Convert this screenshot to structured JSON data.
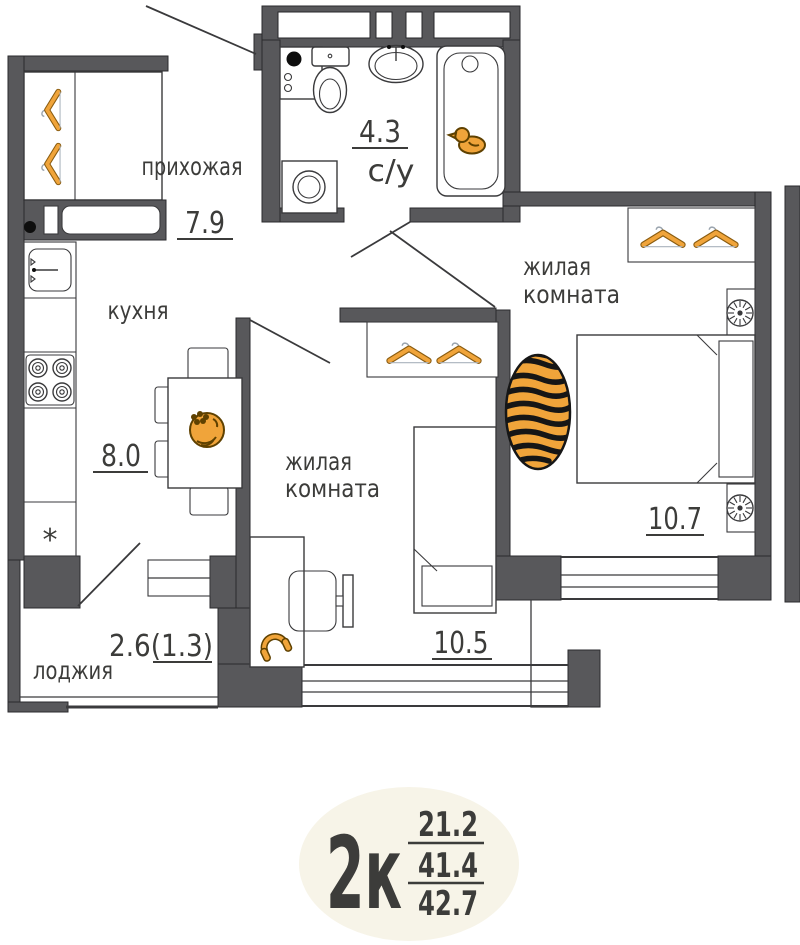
{
  "plan": {
    "rooms": {
      "hallway": {
        "name": "прихожая",
        "area": "7.9"
      },
      "bathroom": {
        "name": "с/у",
        "area": "4.3"
      },
      "kitchen": {
        "name": "кухня",
        "area": "8.0",
        "fridge_symbol": "*"
      },
      "living_room": {
        "name_lines": [
          "жилая",
          "комната"
        ],
        "area": "10.5"
      },
      "bedroom": {
        "name_lines": [
          "жилая",
          "комната"
        ],
        "area": "10.7"
      },
      "loggia": {
        "name": "лоджия",
        "area": "2.6(1.3)"
      }
    },
    "badge": {
      "label": "2к",
      "values": [
        "21.2",
        "41.4",
        "42.7"
      ]
    },
    "colors": {
      "wall": "#58585b",
      "line": "#3a3a3c",
      "text": "#3c3c3a",
      "accent": "#f0a43a",
      "badge": "#f7f4e8"
    },
    "icons": [
      "hanger-icon",
      "rubber-duck-icon",
      "fruit-bowl-icon",
      "headphones-icon",
      "tiger-rug-icon",
      "nightstand-lamp-icon",
      "stove-burner-icon",
      "kitchen-sink-icon",
      "bathtub-icon",
      "toilet-icon",
      "washbasin-icon",
      "washing-machine-icon",
      "electrical-panel-icon",
      "monitor-icon"
    ]
  }
}
